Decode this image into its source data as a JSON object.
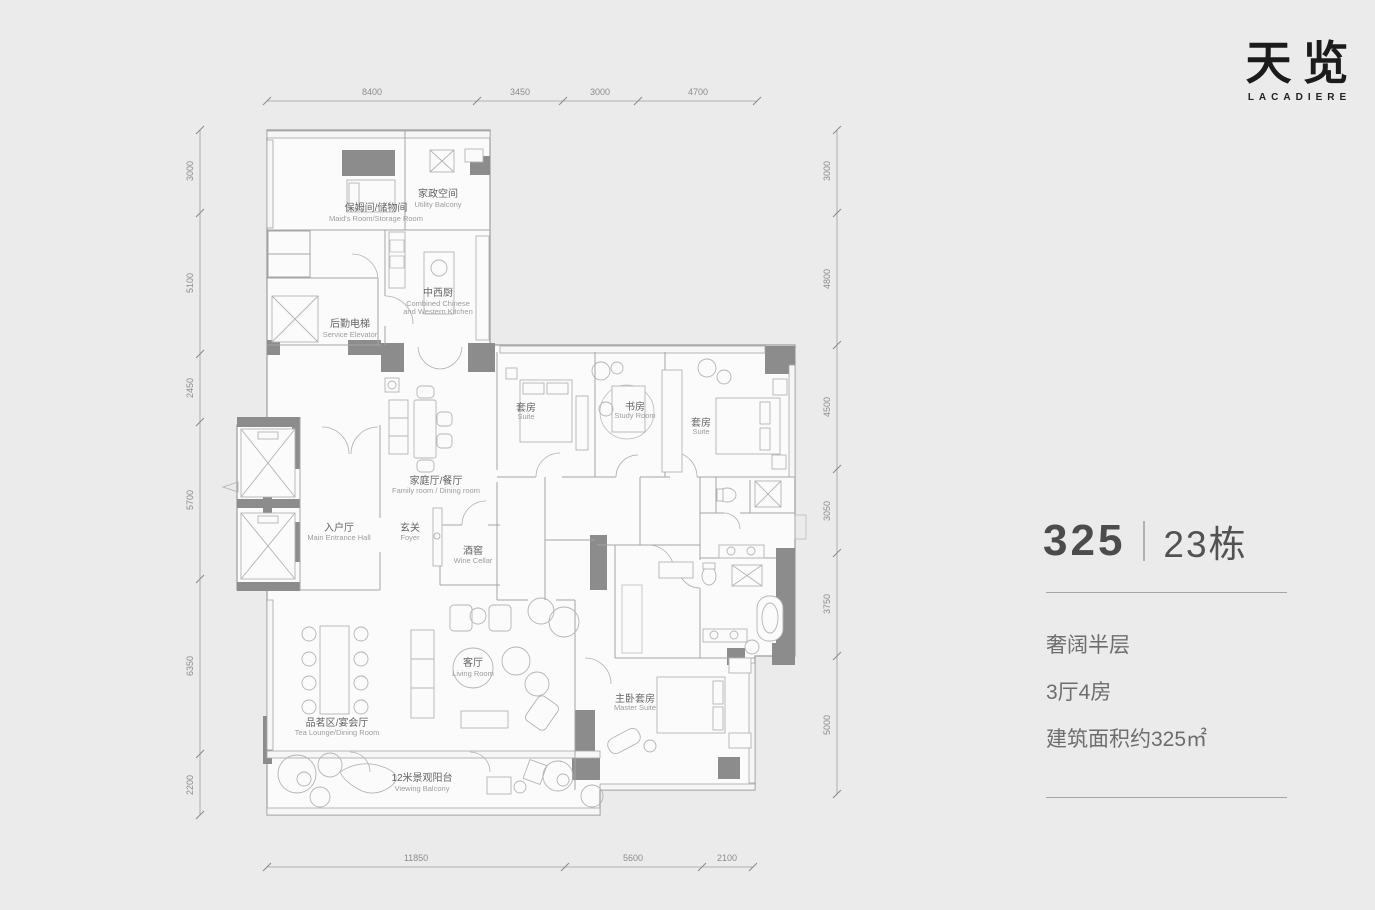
{
  "logo": {
    "title_cn": "天览",
    "subtitle": "LACADIERE"
  },
  "unit_info": {
    "unit_number": "325",
    "building": "23栋",
    "feature_1": "奢阔半层",
    "feature_2": "3厅4房",
    "feature_3": "建筑面积约325㎡"
  },
  "dimensions": {
    "top": [
      "8400",
      "3450",
      "3000",
      "4700"
    ],
    "left": [
      "3000",
      "5100",
      "2450",
      "5700",
      "6350",
      "2200"
    ],
    "right": [
      "3000",
      "4800",
      "4500",
      "3050",
      "3750",
      "5000"
    ],
    "bottom": [
      "11850",
      "5600",
      "2100"
    ]
  },
  "rooms": {
    "maid": {
      "cn": "保姆间/储物间",
      "en": "Maid's Room/Storage Room"
    },
    "utility": {
      "cn": "家政空间",
      "en": "Utility Balcony"
    },
    "service_elevator": {
      "cn": "后勤电梯",
      "en": "Service Elevator"
    },
    "kitchen": {
      "cn": "中西厨",
      "en": "Combined Chinese",
      "en2": "and Western Kitchen"
    },
    "family": {
      "cn": "家庭厅/餐厅",
      "en": "Family room / Dining room"
    },
    "entrance": {
      "cn": "入户厅",
      "en": "Main Entrance Hall"
    },
    "foyer": {
      "cn": "玄关",
      "en": "Foyer"
    },
    "wine": {
      "cn": "酒窖",
      "en": "Wine Cellar"
    },
    "suite1": {
      "cn": "套房",
      "en": "Suite"
    },
    "study": {
      "cn": "书房",
      "en": "Study Room"
    },
    "suite2": {
      "cn": "套房",
      "en": "Suite"
    },
    "living": {
      "cn": "客厅",
      "en": "Living Room"
    },
    "tea": {
      "cn": "品茗区/宴会厅",
      "en": "Tea Lounge/Dining Room"
    },
    "master": {
      "cn": "主卧套房",
      "en": "Master Suite"
    },
    "balcony": {
      "cn": "12米景观阳台",
      "en": "Viewing Balcony"
    }
  },
  "colors": {
    "background": "#ebebeb",
    "wall": "#8c8c8c",
    "plan_line": "#a5a5a5",
    "logo": "#1b1b1b",
    "text_dark": "#4c4c4c",
    "text_medium": "#6d6d6d"
  }
}
